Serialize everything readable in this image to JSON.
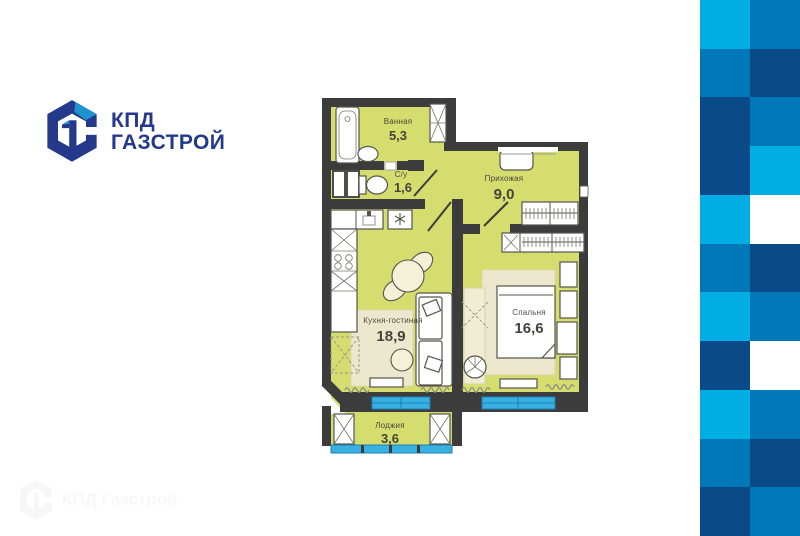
{
  "logo": {
    "title_line1": "КПД",
    "title_line2": "ГАЗСТРОЙ"
  },
  "plan": {
    "rooms": [
      {
        "id": "bathroom",
        "name": "Ванная",
        "area": "5,3"
      },
      {
        "id": "wc",
        "name": "С/у",
        "area": "1,6"
      },
      {
        "id": "hallway",
        "name": "Прихожая",
        "area": "9,0"
      },
      {
        "id": "kitchen_living",
        "name": "Кухня-гостиная",
        "area": "18,9"
      },
      {
        "id": "bedroom",
        "name": "Спальня",
        "area": "16,6"
      },
      {
        "id": "loggia",
        "name": "Лоджия",
        "area": "3,6"
      }
    ]
  },
  "watermark": {
    "text": "КПД Газстрой"
  },
  "colors": {
    "logo_navy": "#24388c",
    "logo_blue": "#1e93ce",
    "wall": "#3d3c3c",
    "room_fill": "#d5dd6f",
    "furniture_beige": "#f5f1d8",
    "rug_beige": "#ebe8cd",
    "window_blue": "#38b0e2",
    "window_blue_dark": "#1a7fb5",
    "label_text": "#4b4940",
    "checker_light": "#00ADE4",
    "checker_medium": "#0078B8",
    "checker_dark": "#0A4A88",
    "checker_white": "#ffffff"
  },
  "checkerboard": {
    "rows": [
      [
        "L",
        "M"
      ],
      [
        "M",
        "D"
      ],
      [
        "D",
        "M"
      ],
      [
        "D",
        "L"
      ],
      [
        "L",
        "W"
      ],
      [
        "M",
        "D"
      ],
      [
        "L",
        "M"
      ],
      [
        "D",
        "W"
      ],
      [
        "L",
        "M"
      ],
      [
        "M",
        "D"
      ],
      [
        "D",
        "M"
      ]
    ]
  }
}
